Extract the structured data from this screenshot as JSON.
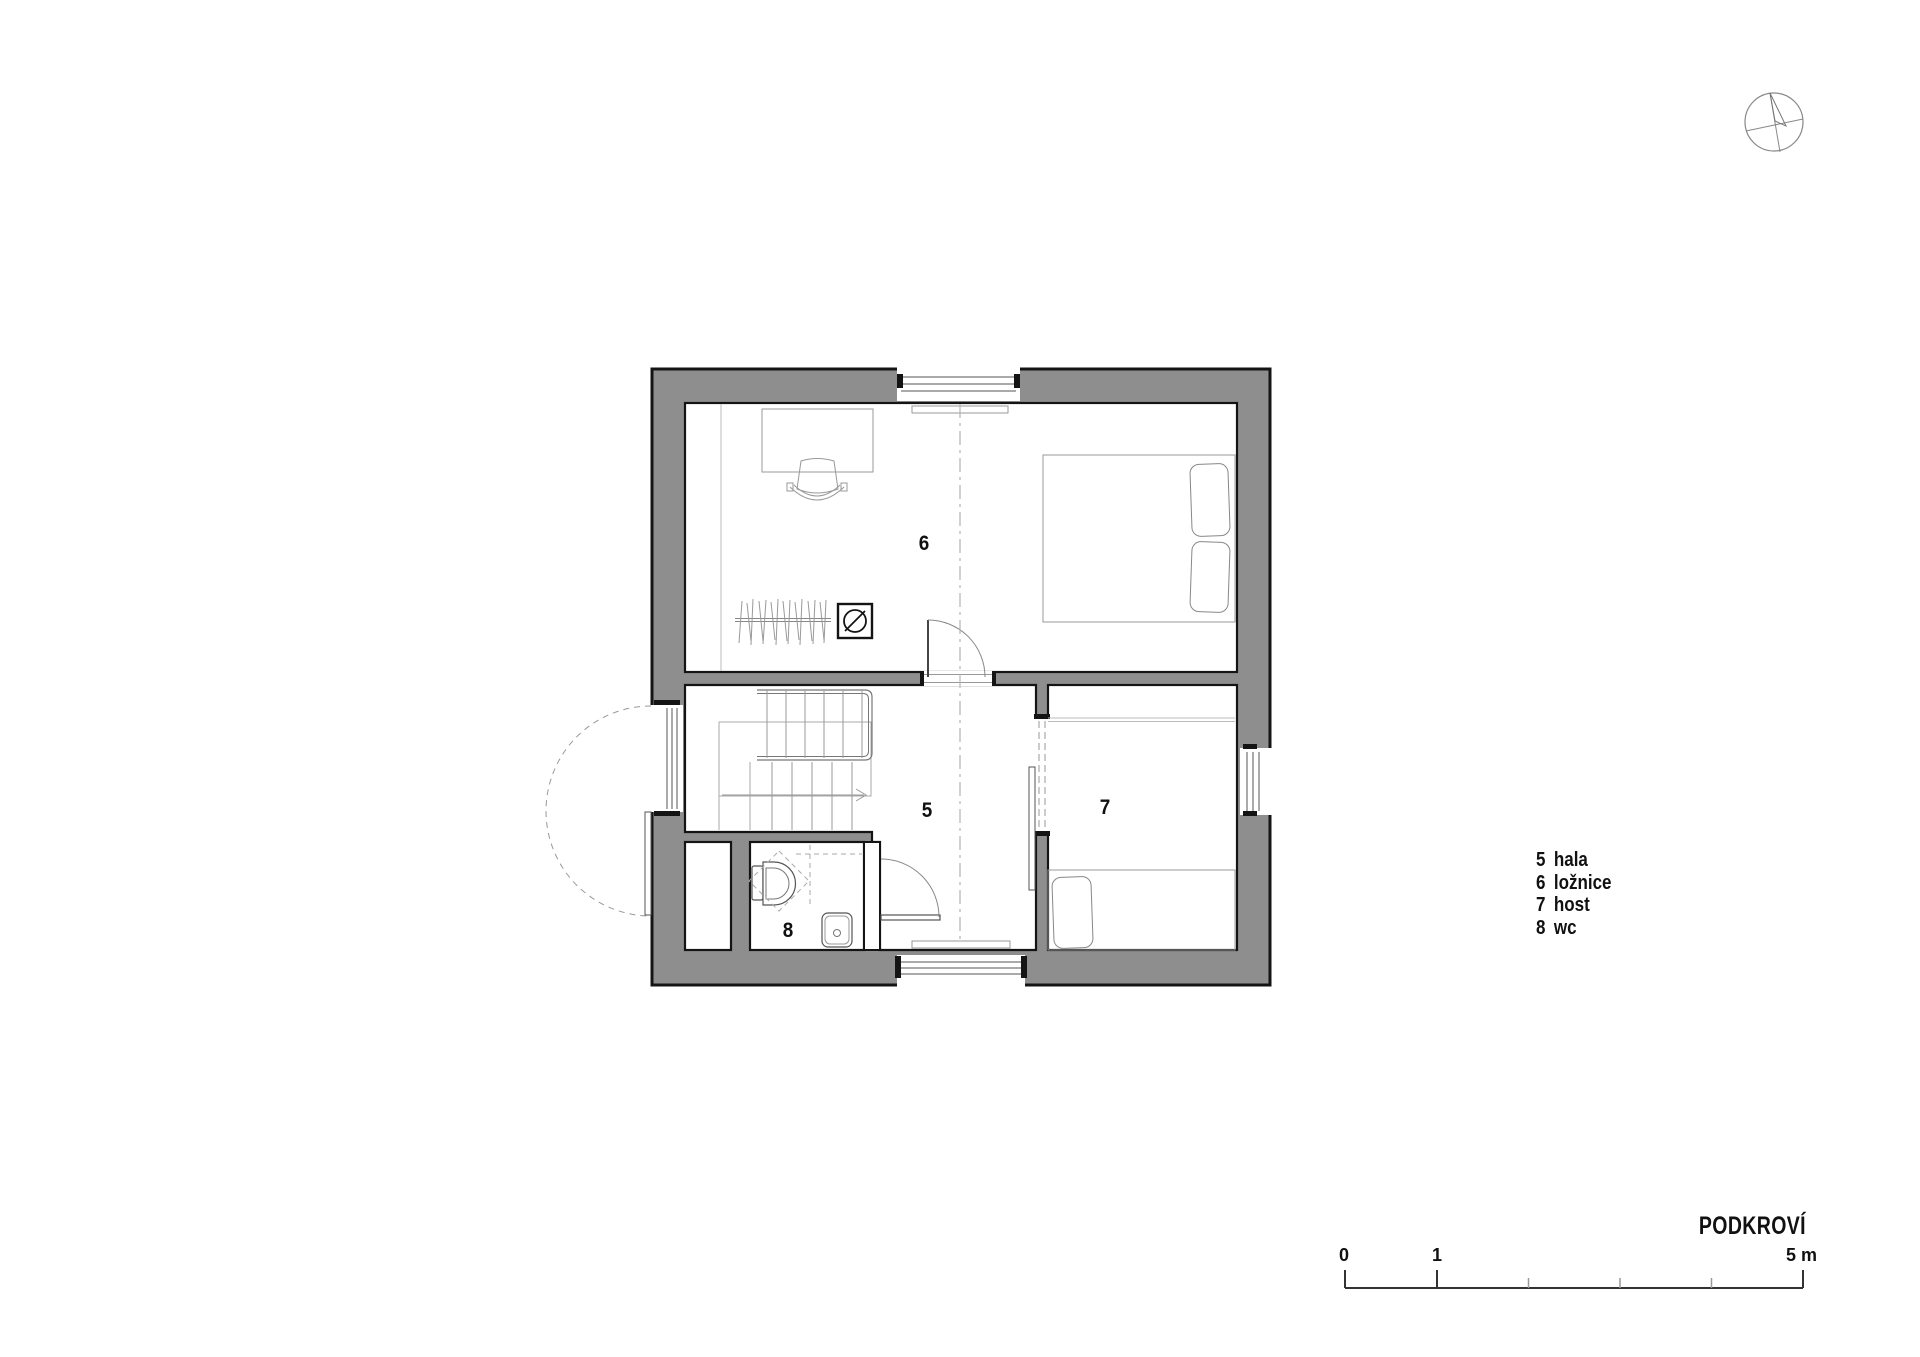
{
  "meta": {
    "title": "PODKROVÍ"
  },
  "rooms": [
    {
      "number": "5",
      "name": "hala"
    },
    {
      "number": "6",
      "name": "ložnice"
    },
    {
      "number": "7",
      "name": "host"
    },
    {
      "number": "8",
      "name": "wc"
    }
  ],
  "scalebar": {
    "zero": "0",
    "one": "1",
    "five": "5 m"
  },
  "icons": [
    "north-arrow-icon",
    "chimney-icon",
    "toilet-icon",
    "sink-icon"
  ],
  "colors": {
    "wall_fill": "#8e8e8e",
    "outline": "#141414",
    "furniture_line": "#999999",
    "dash_line": "#b3b3b3"
  }
}
